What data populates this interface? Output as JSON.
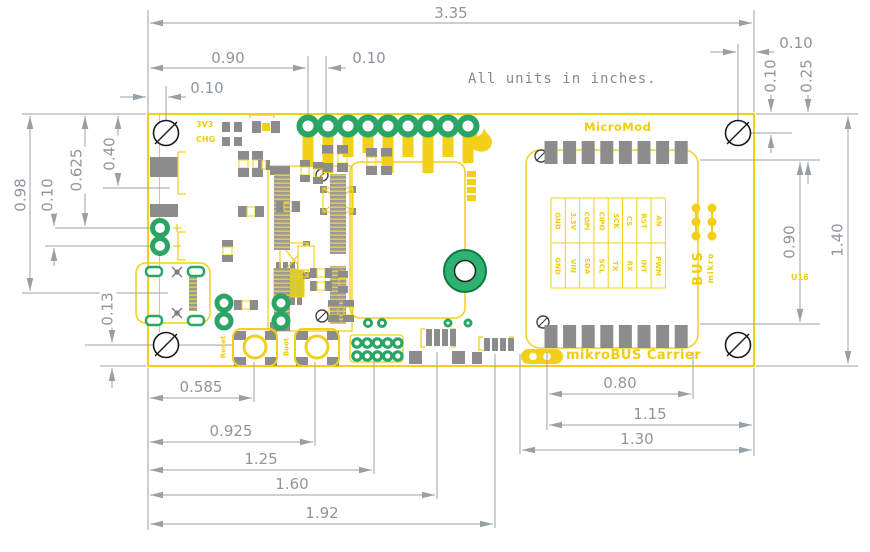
{
  "note": "All units in inches.",
  "dimensions": {
    "top_overall": "3.35",
    "top_left_block": "0.90",
    "top_hole_pitch": "0.10",
    "top_left_hole": "0.10",
    "top_right_hole": "0.10",
    "right_hole_from_top": "0.10",
    "right_pads_from_top": "0.25",
    "right_socket_span": "0.90",
    "right_overall": "1.40",
    "left_usb_center": "0.98",
    "left_batt_hole": "0.625",
    "left_conn_line": "0.40",
    "left_batt_pitch": "0.10",
    "left_bottom_hole": "0.13",
    "bottom_left": [
      "0.585",
      "0.925",
      "1.25",
      "1.60",
      "1.92"
    ],
    "bottom_right": [
      "0.80",
      "1.15",
      "1.30"
    ]
  },
  "board": {
    "silk": {
      "pwr_led": "3V3",
      "chg_led": "CHG",
      "module_label": "MicroMod",
      "carrier_label": "mikroBUS Carrier",
      "reset_button": "Reset",
      "boot_button": "Boot",
      "designator": "U16",
      "logo_small": "mikro",
      "logo_big": "BUS"
    },
    "mikrobus_pins": {
      "inner_row": [
        "GND",
        "3.3V",
        "COPI",
        "CIPO",
        "SCK",
        "CS",
        "RST",
        "AN"
      ],
      "outer_row": [
        "GND",
        "VIN",
        "SDA",
        "SCL",
        "TX",
        "RX",
        "INT",
        "PWM"
      ]
    }
  },
  "colors": {
    "silkscreen_yellow": "#f2d01a",
    "pad_gray": "#8c8c8c",
    "plated_green": "#2aa564",
    "dimension_gray": "#98a0a4"
  }
}
